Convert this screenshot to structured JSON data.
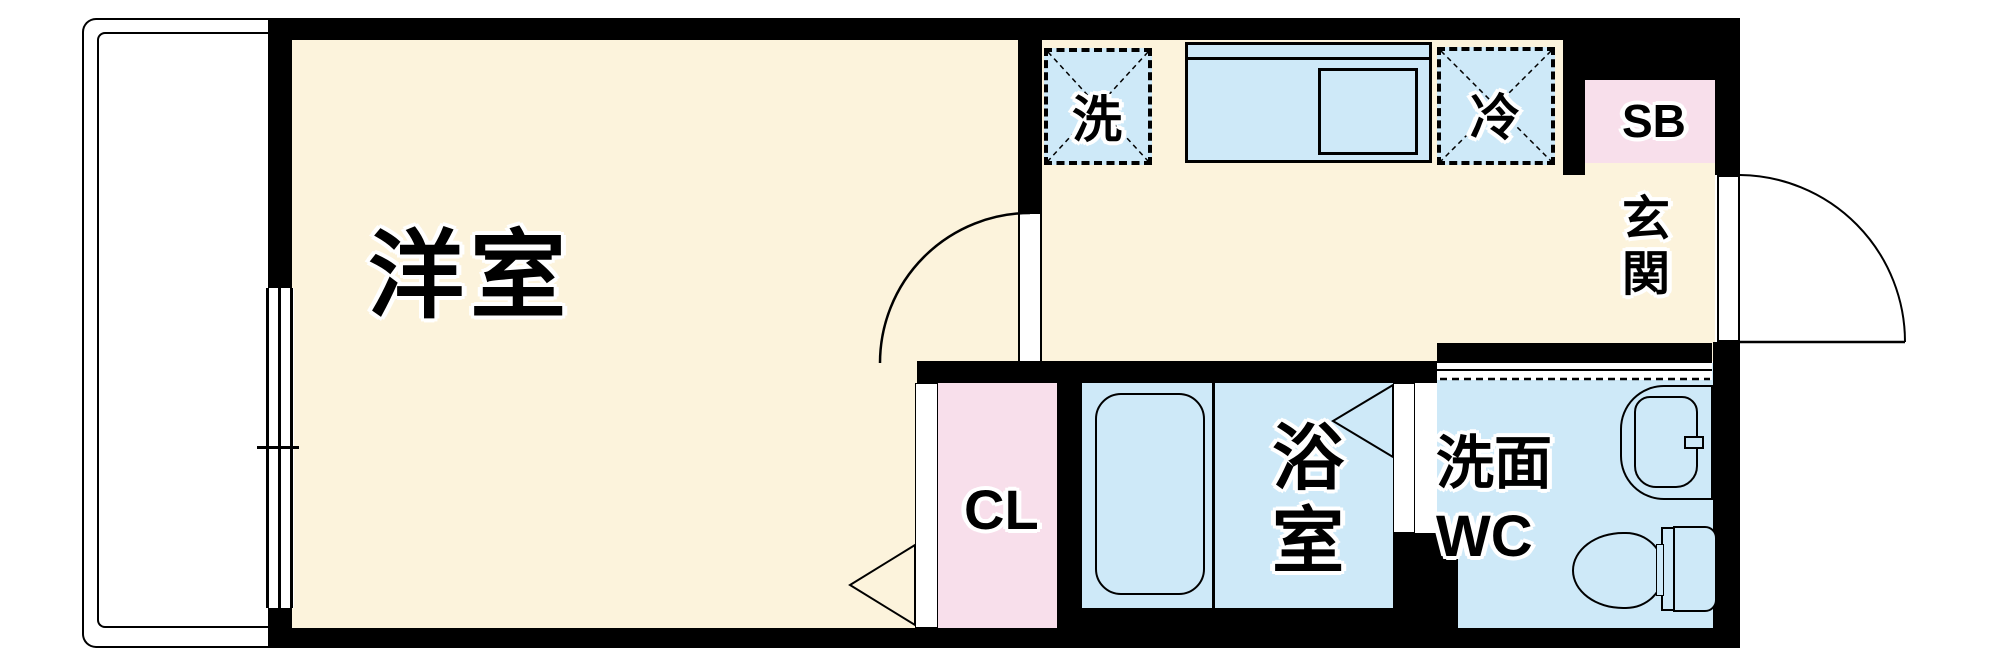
{
  "floorplan": {
    "type": "apartment-floor-plan",
    "rooms": {
      "western_room": {
        "label": "洋室"
      },
      "entrance": {
        "label": "玄関"
      },
      "closet": {
        "label": "CL"
      },
      "bathroom": {
        "label": "浴室"
      },
      "washroom_wc": {
        "label": "洗面WC"
      },
      "shoe_box": {
        "label": "SB"
      },
      "washer_space": {
        "label": "洗"
      },
      "fridge_space": {
        "label": "冷"
      }
    },
    "icons": {
      "balcony": "balcony-railing-icon",
      "window": "sliding-window-icon",
      "kitchen_counter": "kitchen-counter-icon",
      "kitchen_sink": "kitchen-sink-icon",
      "bathtub": "bathtub-icon",
      "toilet": "toilet-icon",
      "washbasin": "washbasin-icon",
      "door_swing": "door-swing-arc-icon",
      "folding_door": "folding-door-triangle-icon"
    },
    "colors": {
      "floor_cream": "#fcf3dc",
      "wet_area_blue": "#cee9f8",
      "storage_pink": "#f8dfeb",
      "wall_black": "#000000",
      "background_white": "#ffffff"
    }
  }
}
